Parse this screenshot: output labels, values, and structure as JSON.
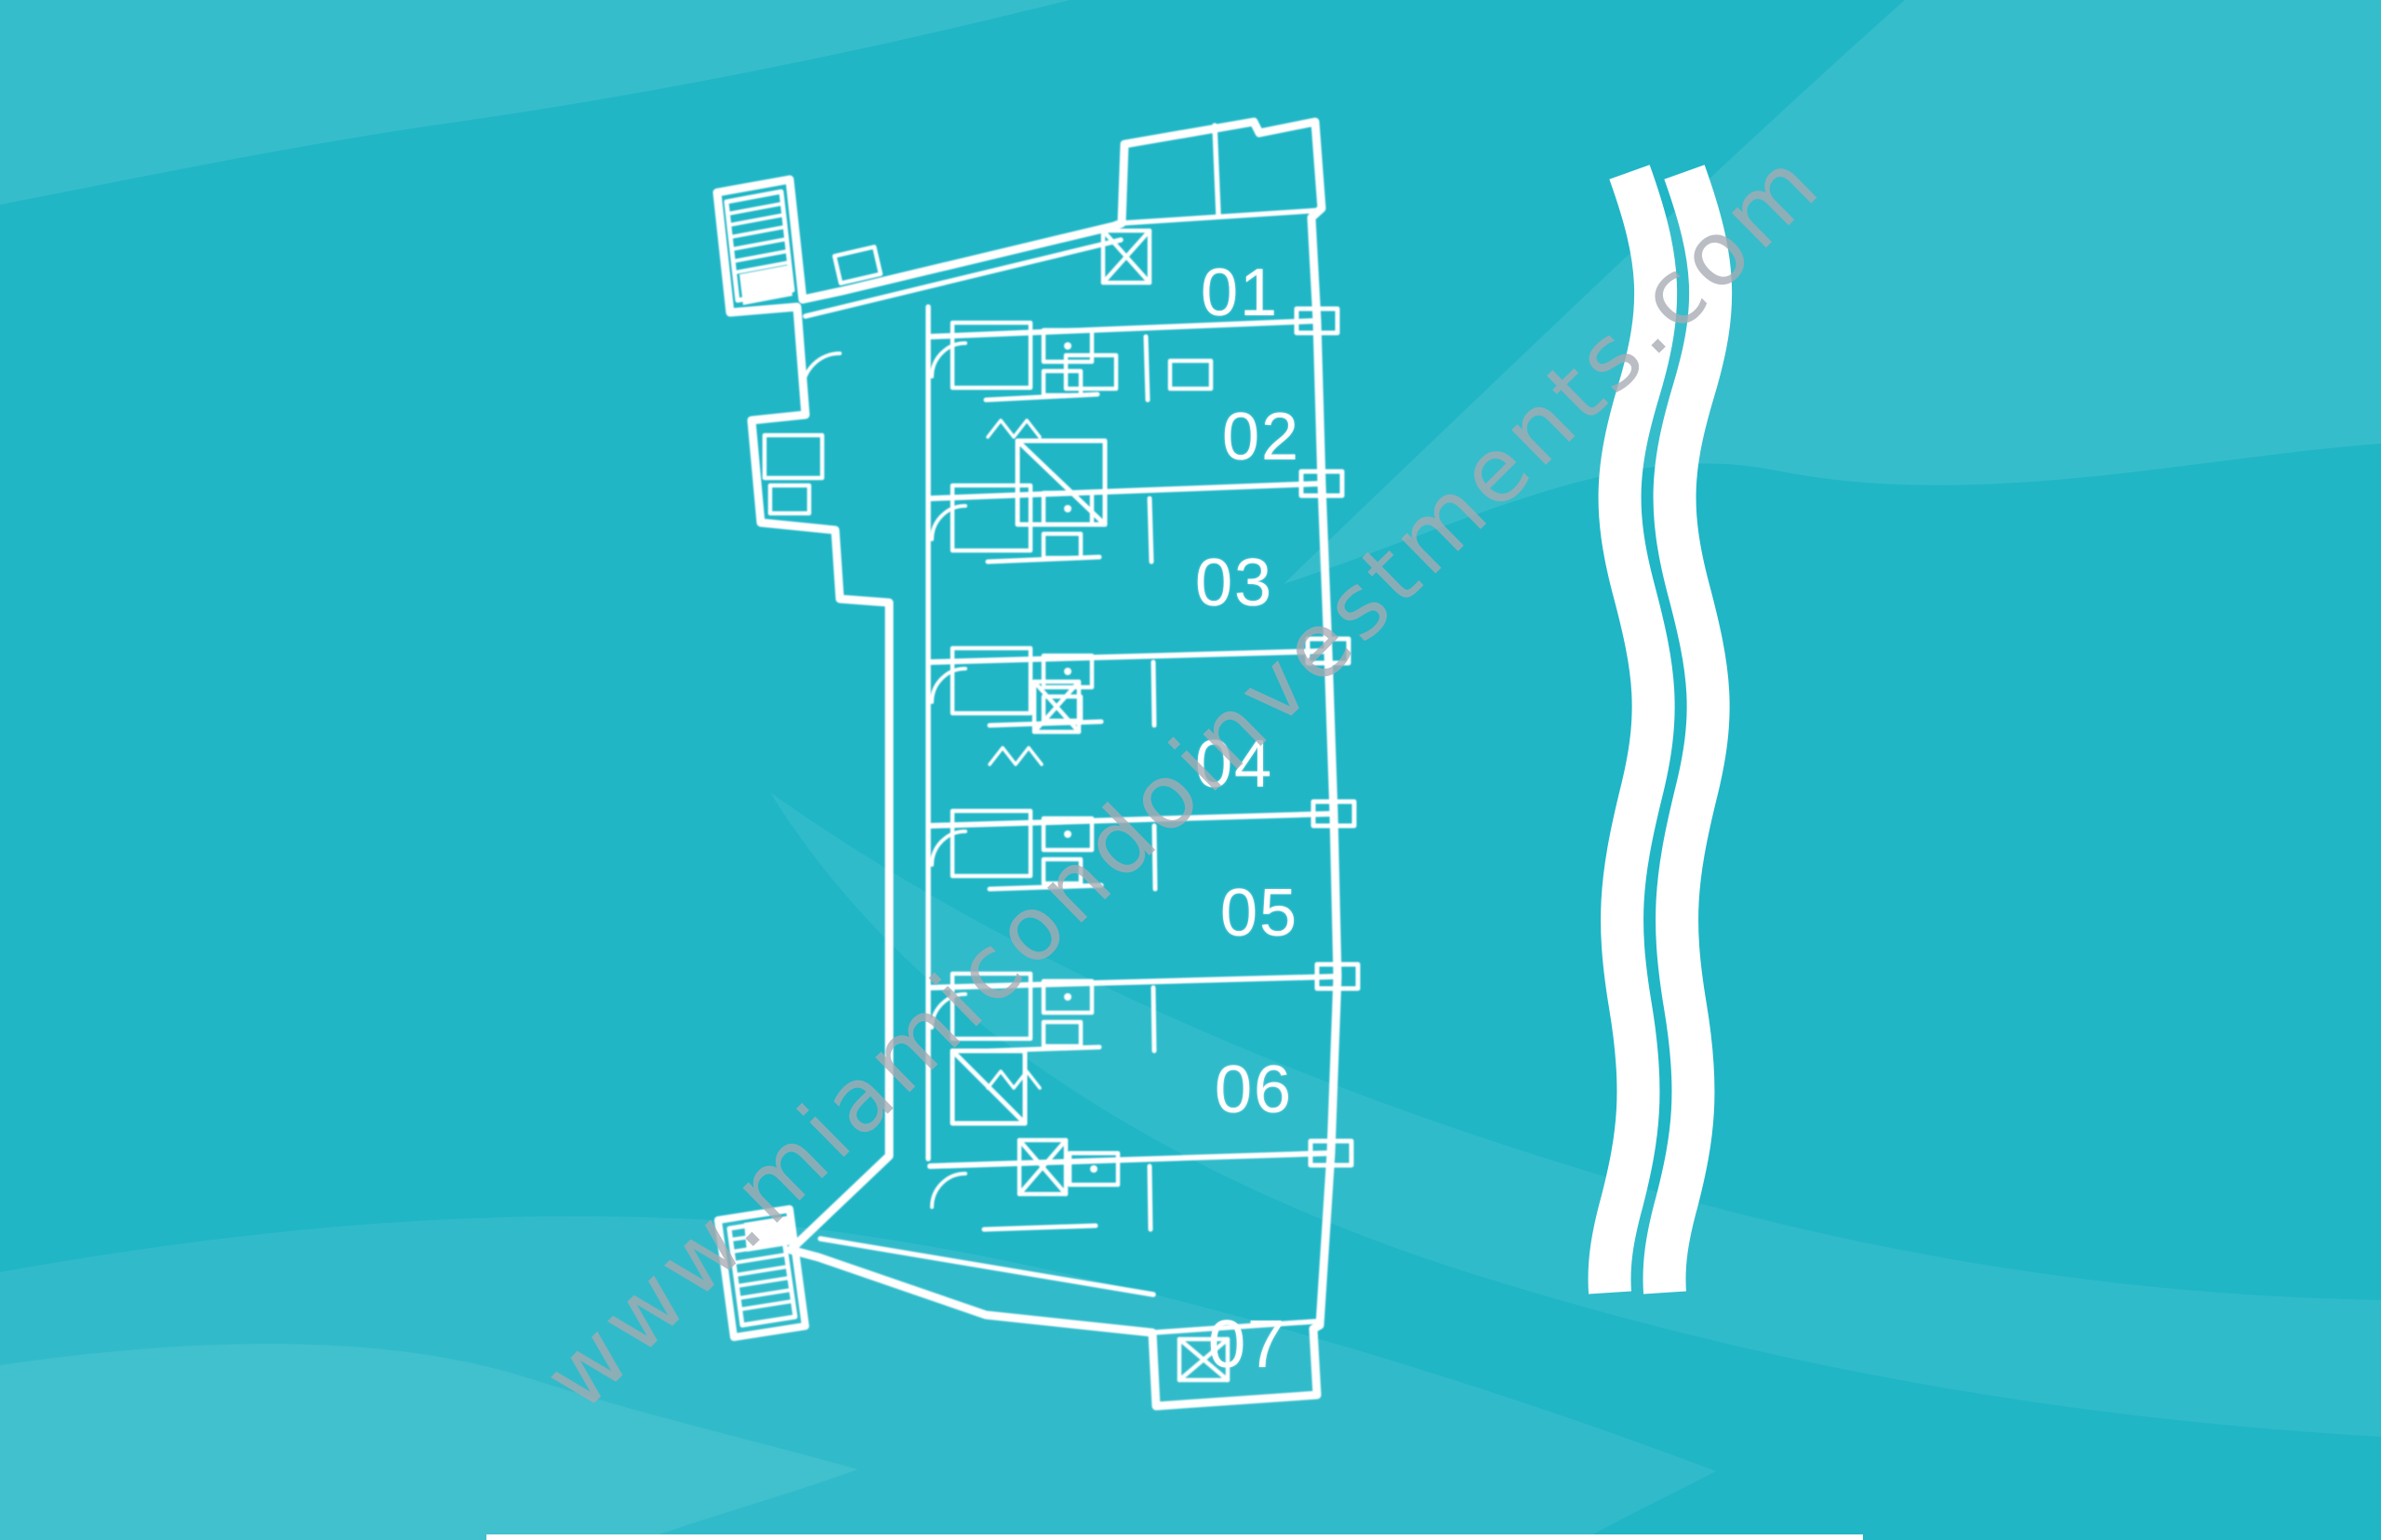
{
  "background": {
    "base_color": "#20b6c6",
    "band_tint": "rgba(255,255,255,0.09)"
  },
  "floor_plan": {
    "line_color": "#ffffff",
    "units": [
      {
        "label": "01"
      },
      {
        "label": "02"
      },
      {
        "label": "03"
      },
      {
        "label": "04"
      },
      {
        "label": "05"
      },
      {
        "label": "06"
      },
      {
        "label": "07"
      }
    ]
  },
  "watermark": {
    "text": "www.miamicondoinvestments.com"
  }
}
